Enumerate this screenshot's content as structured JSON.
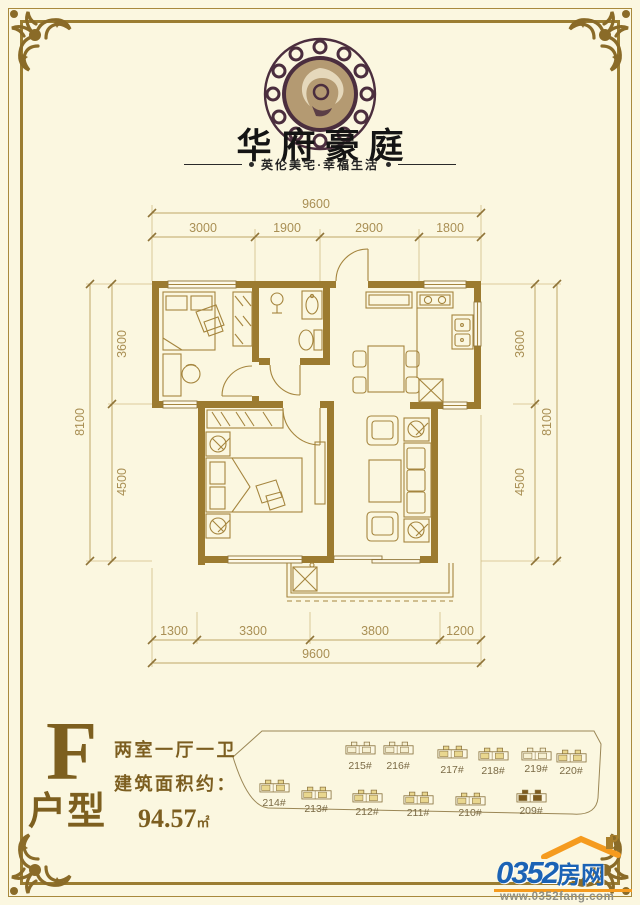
{
  "brand": {
    "title": "华府豪庭",
    "subtitle": "英伦美宅·幸福生活",
    "emblem_icon": "phoenix-medallion-icon"
  },
  "floor_plan": {
    "wall_color": "#9c7b30",
    "line_color": "#a5853e",
    "dims": {
      "top_total": "9600",
      "top_segments": [
        "3000",
        "1900",
        "2900",
        "1800"
      ],
      "side_total": "8100",
      "side_segments": [
        "3600",
        "4500"
      ],
      "bottom_segments": [
        "1300",
        "3300",
        "3800",
        "1200"
      ],
      "bottom_total": "9600"
    }
  },
  "unit_info": {
    "type_letter": "F",
    "type_label": "户型",
    "layout": "两室一厅一卫",
    "area_label": "建筑面积约：",
    "area_value": "94.57",
    "area_unit": "㎡"
  },
  "site_plan": {
    "highlight_color": "#7d5b1e",
    "buildings": [
      {
        "label": "215#",
        "color": "#f6f0d2"
      },
      {
        "label": "216#",
        "color": "#f6f0d2"
      },
      {
        "label": "217#",
        "color": "#e9d78f"
      },
      {
        "label": "218#",
        "color": "#e9d78f"
      },
      {
        "label": "219#",
        "color": "#f6f0d2"
      },
      {
        "label": "220#",
        "color": "#e9d78f"
      },
      {
        "label": "214#",
        "color": "#e9d78f"
      },
      {
        "label": "213#",
        "color": "#e9d78f"
      },
      {
        "label": "212#",
        "color": "#e9d78f"
      },
      {
        "label": "211#",
        "color": "#e9d78f"
      },
      {
        "label": "210#",
        "color": "#e9d78f"
      },
      {
        "label": "209#",
        "color": "#7d5b1e"
      }
    ]
  },
  "footer_logo": {
    "brand_number": "0352",
    "brand_suffix": "房网",
    "url": "www.0352fang.com",
    "accent_color": "#f59b1f",
    "blue_color": "#1b63b5",
    "roof_icon": "house-roof-icon"
  }
}
